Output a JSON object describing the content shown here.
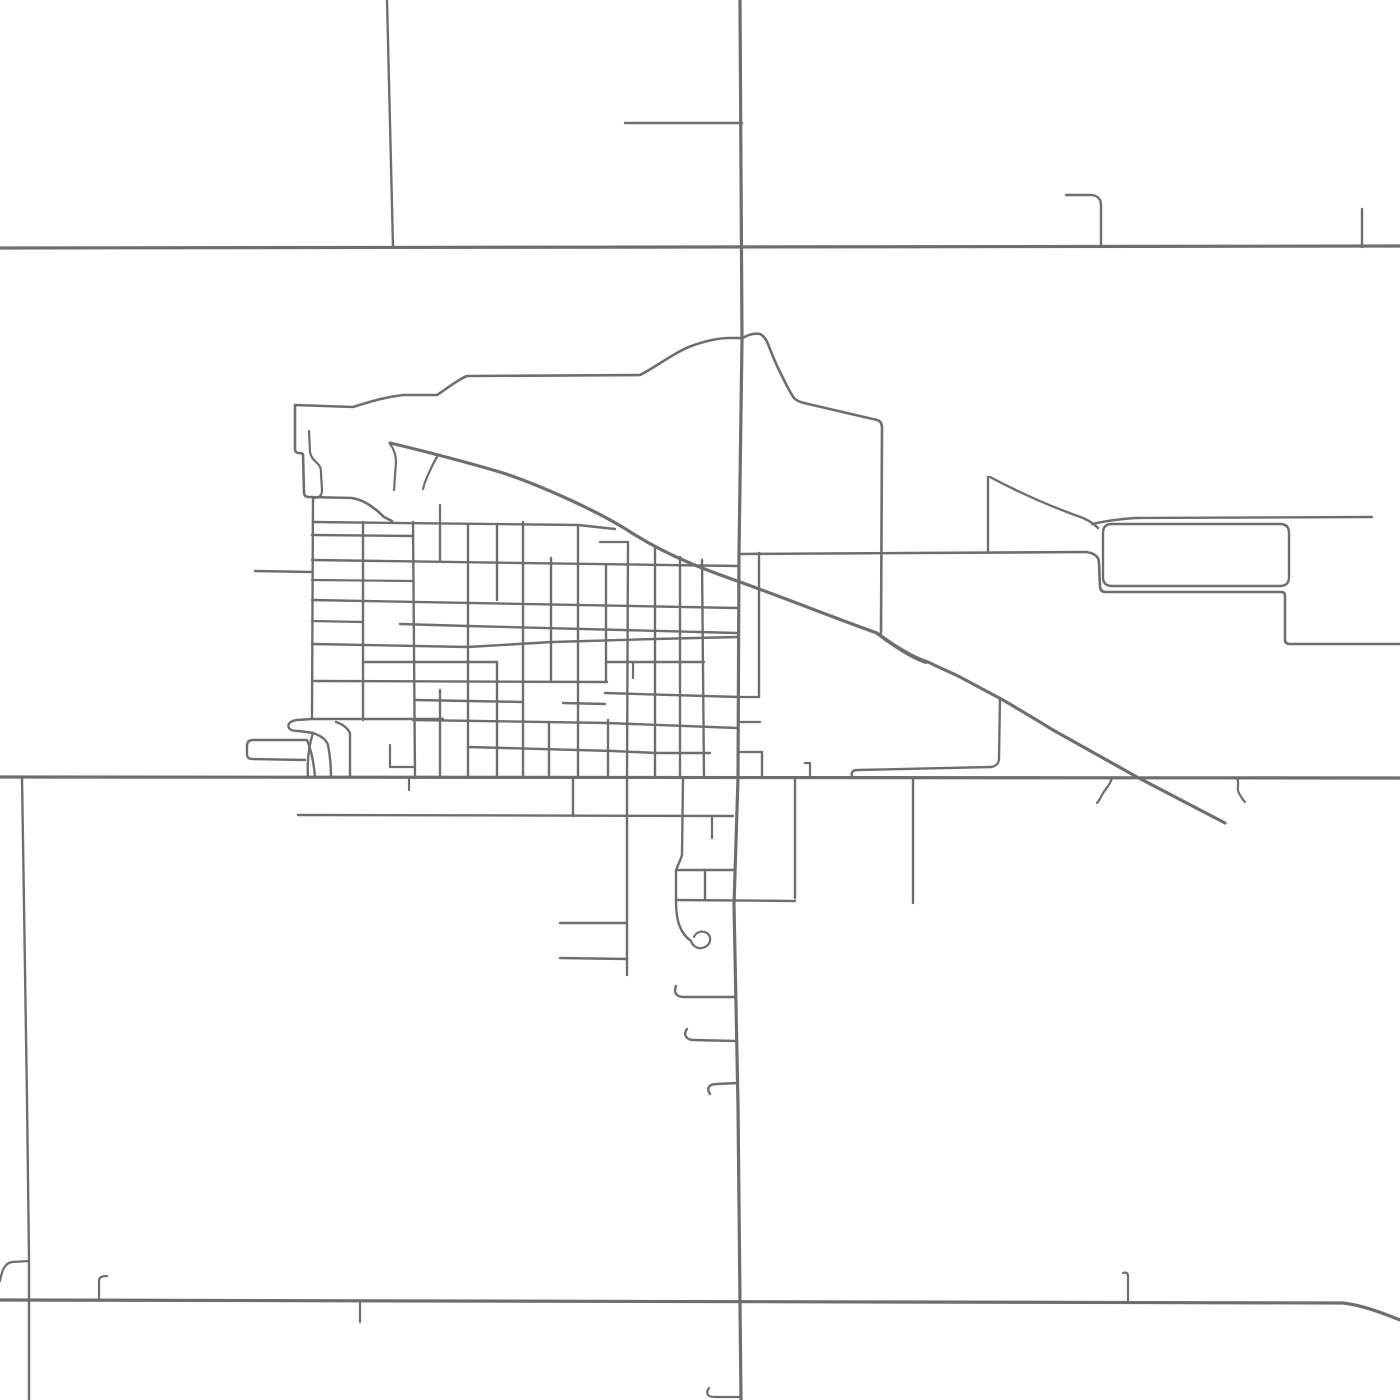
{
  "canvas": {
    "width": 1400,
    "height": 1400,
    "background": "#ffffff"
  },
  "palette": {
    "road_stroke": "#6e6e6e"
  },
  "map": {
    "kind": "street-network-map",
    "roads": [
      {
        "n": "highway-north-east-west",
        "w": 3.2,
        "d": "M0,248 L1400,246"
      },
      {
        "n": "highway-middle-east-west",
        "w": 3.2,
        "d": "M0,777 L1400,778"
      },
      {
        "n": "highway-south-east-west",
        "w": 3.2,
        "d": "M0,1300 L1343,1303 C1362,1305 1383,1313 1400,1320"
      },
      {
        "n": "main-road-north-south",
        "w": 3.2,
        "d": "M740,0 L742,340 L739,554 L738,778 L734,905 L736,1005 L738,1105 L740,1303 L741,1400"
      },
      {
        "n": "diagonal-highway",
        "w": 3.2,
        "d": "M390,443 C420,450 470,463 503,473 C540,485 600,512 632,533 C670,557 706,570 740,582 C790,600 840,620 877,633 C895,646 912,657 928,662 C940,668 950,672 960,677 L1003,700 C1020,710 1040,722 1053,730 L1137,777 L1225,823"
      },
      {
        "n": "east-connector-road",
        "w": 2.6,
        "d": "M739,554 L1086,552 C1094,553 1099,556 1099,563 L1100,586 C1100,590 1102,592 1106,592 L1281,592 C1284,592 1285,593 1285,597 L1285,640 C1285,643 1287,644 1290,644 L1400,644"
      },
      {
        "n": "town-boundary-north",
        "w": 2.6,
        "d": "M295,405 L353,407 C372,401 386,397 403,395 L437,395 C448,388 457,380 467,376 L640,375 C656,367 676,351 694,345 C706,341 718,338 729,338 L743,338 C749,334 756,333 760,334 C764,336 766,339 768,344 C772,354 775,362 779,370 C784,380 789,391 794,398 C797,401 800,402 804,403 L877,420 C881,421 882,424 882,428 L881,633"
      },
      {
        "n": "town-boundary-west",
        "w": 2.6,
        "d": "M295,405 L295,448 C295,452 296,453 300,453 L303,454 L304,492 C304,496 306,497 309,497 L352,498 C365,500 376,509 384,517 L392,521"
      },
      {
        "n": "frontage-loop-road",
        "w": 2.4,
        "d": "M853,778 C850,773 852,770 858,770 L991,767 C997,766 999,763 999,758 L1000,698"
      },
      {
        "n": "pond-inner-lane",
        "w": 2.2,
        "d": "M309,431 L310,452 C311,458 315,461 318,464 C321,467 321,470 321,474 L322,490 C322,496 319,498 313,498"
      },
      {
        "n": "north-section-line",
        "w": 2.4,
        "d": "M387,0 L393,247"
      },
      {
        "n": "north-stub-road",
        "w": 2.4,
        "d": "M625,123 L742,123"
      },
      {
        "n": "northeast-hook-road",
        "w": 2.4,
        "d": "M1066,195 L1092,195 C1098,196 1101,199 1101,205 L1101,247"
      },
      {
        "n": "northeast-tick-road",
        "w": 2.4,
        "d": "M1362,209 L1362,247"
      },
      {
        "n": "diagonal-spur-a",
        "w": 2.2,
        "d": "M390,444 C394,449 396,455 396,462 L394,490"
      },
      {
        "n": "diagonal-spur-b",
        "w": 2.2,
        "d": "M437,457 C432,465 428,475 425,482 L423,489"
      },
      {
        "n": "grid-tick-north",
        "w": 2.2,
        "d": "M440,505 L440,522"
      },
      {
        "n": "funnel-top-edge",
        "w": 2.4,
        "d": "M990,477 C1020,493 1055,508 1083,518 C1090,521 1094,524 1098,528"
      },
      {
        "n": "funnel-left-edge",
        "w": 2.4,
        "d": "M988,477 L988,551"
      },
      {
        "n": "east-rounded-block",
        "w": 2.4,
        "d": "M1112,524 H1280 Q1289,524 1289,533 V577 Q1289,586 1280,586 H1112 Q1103,586 1103,577 V533 Q1103,524 1112,524"
      },
      {
        "n": "east-upper-road",
        "w": 2.4,
        "d": "M1092,524 C1105,521 1120,519 1135,518 L1372,517"
      },
      {
        "n": "diagonal-island-edge",
        "w": 2.2,
        "d": "M877,634 C897,649 913,659 926,663"
      },
      {
        "n": "grid-street-v-312",
        "w": 2.4,
        "d": "M313,499 L312,718"
      },
      {
        "n": "grid-street-v-363",
        "w": 2.4,
        "d": "M363,522 L363,720"
      },
      {
        "n": "grid-street-v-414",
        "w": 2.4,
        "d": "M413,522 L415,778"
      },
      {
        "n": "grid-street-v-440a",
        "w": 2.4,
        "d": "M440,522 L440,562"
      },
      {
        "n": "grid-street-v-440b",
        "w": 2.4,
        "d": "M440,690 L440,778"
      },
      {
        "n": "grid-street-v-468",
        "w": 2.4,
        "d": "M468,524 L468,778"
      },
      {
        "n": "grid-street-v-497a",
        "w": 2.4,
        "d": "M497,524 L497,600"
      },
      {
        "n": "grid-street-v-497b",
        "w": 2.4,
        "d": "M497,662 L497,778"
      },
      {
        "n": "grid-street-v-523",
        "w": 2.4,
        "d": "M523,522 L523,778"
      },
      {
        "n": "grid-street-v-550a",
        "w": 2.4,
        "d": "M551,558 L551,682"
      },
      {
        "n": "grid-street-v-550b",
        "w": 2.4,
        "d": "M549,722 L549,778"
      },
      {
        "n": "grid-street-v-578",
        "w": 2.4,
        "d": "M578,525 L578,778"
      },
      {
        "n": "grid-street-v-606a",
        "w": 2.4,
        "d": "M606,565 L606,682"
      },
      {
        "n": "grid-street-v-606b",
        "w": 2.4,
        "d": "M608,720 L608,778"
      },
      {
        "n": "grid-street-v-627",
        "w": 2.4,
        "d": "M628,542 L627,778"
      },
      {
        "n": "grid-street-v-655",
        "w": 2.4,
        "d": "M655,547 L655,778"
      },
      {
        "n": "grid-street-v-680",
        "w": 2.4,
        "d": "M680,557 L680,778"
      },
      {
        "n": "grid-street-v-704",
        "w": 2.4,
        "d": "M702,560 L704,778"
      },
      {
        "n": "grid-street-v-759",
        "w": 2.4,
        "d": "M759,553 L759,697"
      },
      {
        "n": "grid-street-v-762",
        "w": 2.4,
        "d": "M762,752 L762,778"
      },
      {
        "n": "grid-alley-v-633",
        "w": 2.2,
        "d": "M633,662 L633,678"
      },
      {
        "n": "grid-street-h-522",
        "w": 2.4,
        "d": "M313,522 L578,525 L615,529"
      },
      {
        "n": "grid-street-h-535",
        "w": 2.4,
        "d": "M312,535 L413,536"
      },
      {
        "n": "grid-stub-h-543",
        "w": 2.2,
        "d": "M600,542 L627,542"
      },
      {
        "n": "grid-street-h-562",
        "w": 2.4,
        "d": "M312,560 L737,566"
      },
      {
        "n": "grid-stub-h-580",
        "w": 2.2,
        "d": "M312,580 L412,581"
      },
      {
        "n": "grid-street-h-600",
        "w": 2.4,
        "d": "M312,600 L737,608"
      },
      {
        "n": "grid-stub-h-621",
        "w": 2.2,
        "d": "M312,621 L363,622"
      },
      {
        "n": "grid-street-h-628",
        "w": 2.4,
        "d": "M400,624 L468,626 L737,633"
      },
      {
        "n": "grid-street-h-643",
        "w": 2.4,
        "d": "M312,644 L468,647 L552,642 L655,639 L737,637"
      },
      {
        "n": "grid-street-h-662a",
        "w": 2.4,
        "d": "M363,662 L497,662"
      },
      {
        "n": "grid-street-h-662b",
        "w": 2.4,
        "d": "M607,662 L704,662"
      },
      {
        "n": "grid-street-h-682",
        "w": 2.4,
        "d": "M312,681 L607,682"
      },
      {
        "n": "grid-street-h-695",
        "w": 2.4,
        "d": "M605,693 L739,697"
      },
      {
        "n": "grid-connector-697",
        "w": 2.2,
        "d": "M739,697 L759,697"
      },
      {
        "n": "grid-street-h-700",
        "w": 2.4,
        "d": "M415,700 L523,702"
      },
      {
        "n": "grid-street-h-703",
        "w": 2.4,
        "d": "M563,703 L605,704"
      },
      {
        "n": "grid-street-h-720",
        "w": 2.4,
        "d": "M413,720 L607,723 L737,728"
      },
      {
        "n": "grid-street-h-750",
        "w": 2.4,
        "d": "M468,747 L613,751 L657,753 L710,753"
      },
      {
        "n": "grid-stub-h-722e",
        "w": 2.2,
        "d": "M739,722 L760,722"
      },
      {
        "n": "grid-stub-h-752e",
        "w": 2.2,
        "d": "M739,752 L762,752"
      },
      {
        "n": "grid-t-stub",
        "w": 2.2,
        "d": "M390,745 L390,767 L415,767"
      },
      {
        "n": "grid-tick-south-409",
        "w": 2.2,
        "d": "M409,778 L409,790"
      },
      {
        "n": "west-stub-571",
        "w": 2.4,
        "d": "M255,571 L312,572"
      },
      {
        "n": "claw-street-top",
        "w": 2.4,
        "d": "M443,719 L312,719 L297,720 C290,721 287,724 289,728 C291,731 295,731 299,731 L313,733"
      },
      {
        "n": "claw-funnel-left",
        "w": 2.4,
        "d": "M313,733 C309,745 307,760 308,777"
      },
      {
        "n": "claw-funnel-right",
        "w": 2.4,
        "d": "M313,733 C321,736 326,739 328,745 C330,755 331,765 331,777"
      },
      {
        "n": "claw-east-leg",
        "w": 2.4,
        "d": "M350,777 L350,733 C347,727 342,724 336,722"
      },
      {
        "n": "west-loop-diagonal",
        "w": 2.4,
        "d": "M307,740 C312,752 314,765 315,777"
      },
      {
        "n": "west-loop-road",
        "w": 2.4,
        "d": "M307,740 L253,740 C249,740 247,742 247,746 L247,754 C247,758 249,759 253,759 L305,760"
      },
      {
        "n": "south-street-v-573",
        "w": 2.4,
        "d": "M573,778 L573,816"
      },
      {
        "n": "south-street-v-627",
        "w": 2.4,
        "d": "M627,778 L627,975"
      },
      {
        "n": "south-street-v-683",
        "w": 2.4,
        "d": "M683,778 L682,855 C680,862 677,866 676,871 L676,902 C676,922 681,934 691,941"
      },
      {
        "n": "cul-de-sac-bulb",
        "w": 2.2,
        "d": "M691,941 C693,947 699,950 705,947 C711,944 712,937 707,933 C702,930 696,932 694,937"
      },
      {
        "n": "south-street-h-816",
        "w": 2.4,
        "d": "M298,815 L733,816"
      },
      {
        "n": "south-stub-v-712",
        "w": 2.2,
        "d": "M712,818 L712,838"
      },
      {
        "n": "south-street-h-870",
        "w": 2.4,
        "d": "M676,870 L733,870"
      },
      {
        "n": "south-street-v-705",
        "w": 2.4,
        "d": "M705,870 L705,900"
      },
      {
        "n": "south-street-h-900",
        "w": 2.4,
        "d": "M676,900 L795,901"
      },
      {
        "n": "south-street-v-795",
        "w": 2.4,
        "d": "M795,778 L795,898"
      },
      {
        "n": "south-hook-805",
        "w": 2.2,
        "d": "M805,763 L810,763 L810,777"
      },
      {
        "n": "south-street-v-913",
        "w": 2.4,
        "d": "M913,778 L913,903"
      },
      {
        "n": "south-stub-923",
        "w": 2.4,
        "d": "M560,923 L627,923"
      },
      {
        "n": "south-stub-958",
        "w": 2.4,
        "d": "M560,958 L627,959"
      },
      {
        "n": "south-hook-997",
        "w": 2.4,
        "d": "M676,986 C673,993 677,997 684,997 L735,997"
      },
      {
        "n": "south-hook-1037",
        "w": 2.4,
        "d": "M687,1029 C683,1034 686,1040 693,1040 L736,1041"
      },
      {
        "n": "south-hook-1085",
        "w": 2.4,
        "d": "M710,1094 C706,1088 709,1084 717,1084 L738,1083"
      },
      {
        "n": "southwest-section-line",
        "w": 2.4,
        "d": "M22,777 L24,905 L27,1100 L29,1258 L29,1400"
      },
      {
        "n": "southwest-branch-curve",
        "w": 2.2,
        "d": "M0,1281 C2,1270 5,1263 12,1262 L29,1261"
      },
      {
        "n": "bottom-tick-99",
        "w": 2.2,
        "d": "M99,1300 L99,1281 C99,1277 102,1276 107,1276"
      },
      {
        "n": "bottom-tick-360",
        "w": 2.2,
        "d": "M360,1303 L360,1322"
      },
      {
        "n": "bottom-tick-1128",
        "w": 2.2,
        "d": "M1128,1302 L1128,1276 C1128,1273 1126,1272 1123,1273"
      },
      {
        "n": "bottom-stub-708",
        "w": 2.2,
        "d": "M709,1388 C705,1394 708,1397 715,1397 L740,1397"
      },
      {
        "n": "squiggle-lane-1105",
        "w": 2.2,
        "d": "M1112,778 C1110,786 1104,790 1102,795 C1100,799 1099,801 1097,803"
      },
      {
        "n": "squiggle-lane-1240",
        "w": 2.2,
        "d": "M1237,778 C1240,784 1236,789 1239,793 C1241,797 1243,800 1245,802"
      }
    ]
  }
}
